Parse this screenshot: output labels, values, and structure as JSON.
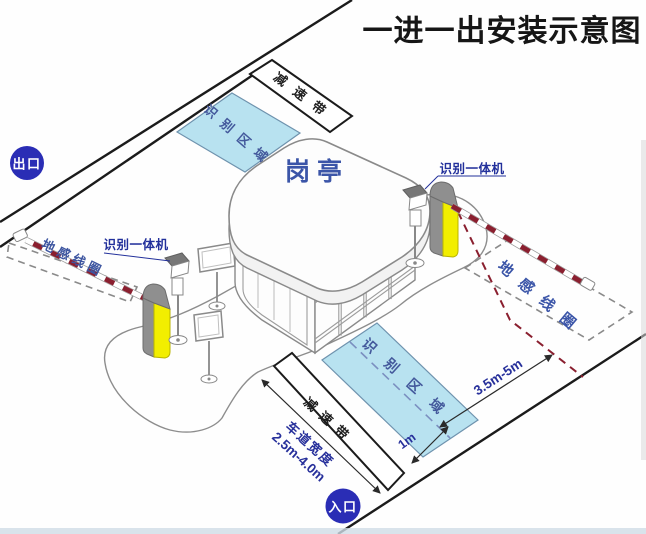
{
  "title": "一进一出安装示意图",
  "badges": {
    "exit": "出口",
    "entry": "入口"
  },
  "booth": {
    "label": "岗亭"
  },
  "zones": {
    "recognition_area": "识别区域",
    "speed_bump": "减速带",
    "ground_loop": "地感线圈"
  },
  "devices": {
    "recognition_camera": "识别一体机"
  },
  "dimensions": {
    "loop_to_area": "3.5m-5m",
    "centerline_offset": "1m",
    "lane_width_label": "车道宽度",
    "lane_width_value": "2.5m-4.0m"
  },
  "colors": {
    "badge_blue": "#2a2db5",
    "zone_fill": "#b8e2f0",
    "booth_label_blue": "#3b55a8",
    "dimension_navy": "#27309b",
    "barrier_red": "#8a1f2f",
    "gate_yellow": "#f2ee00"
  }
}
